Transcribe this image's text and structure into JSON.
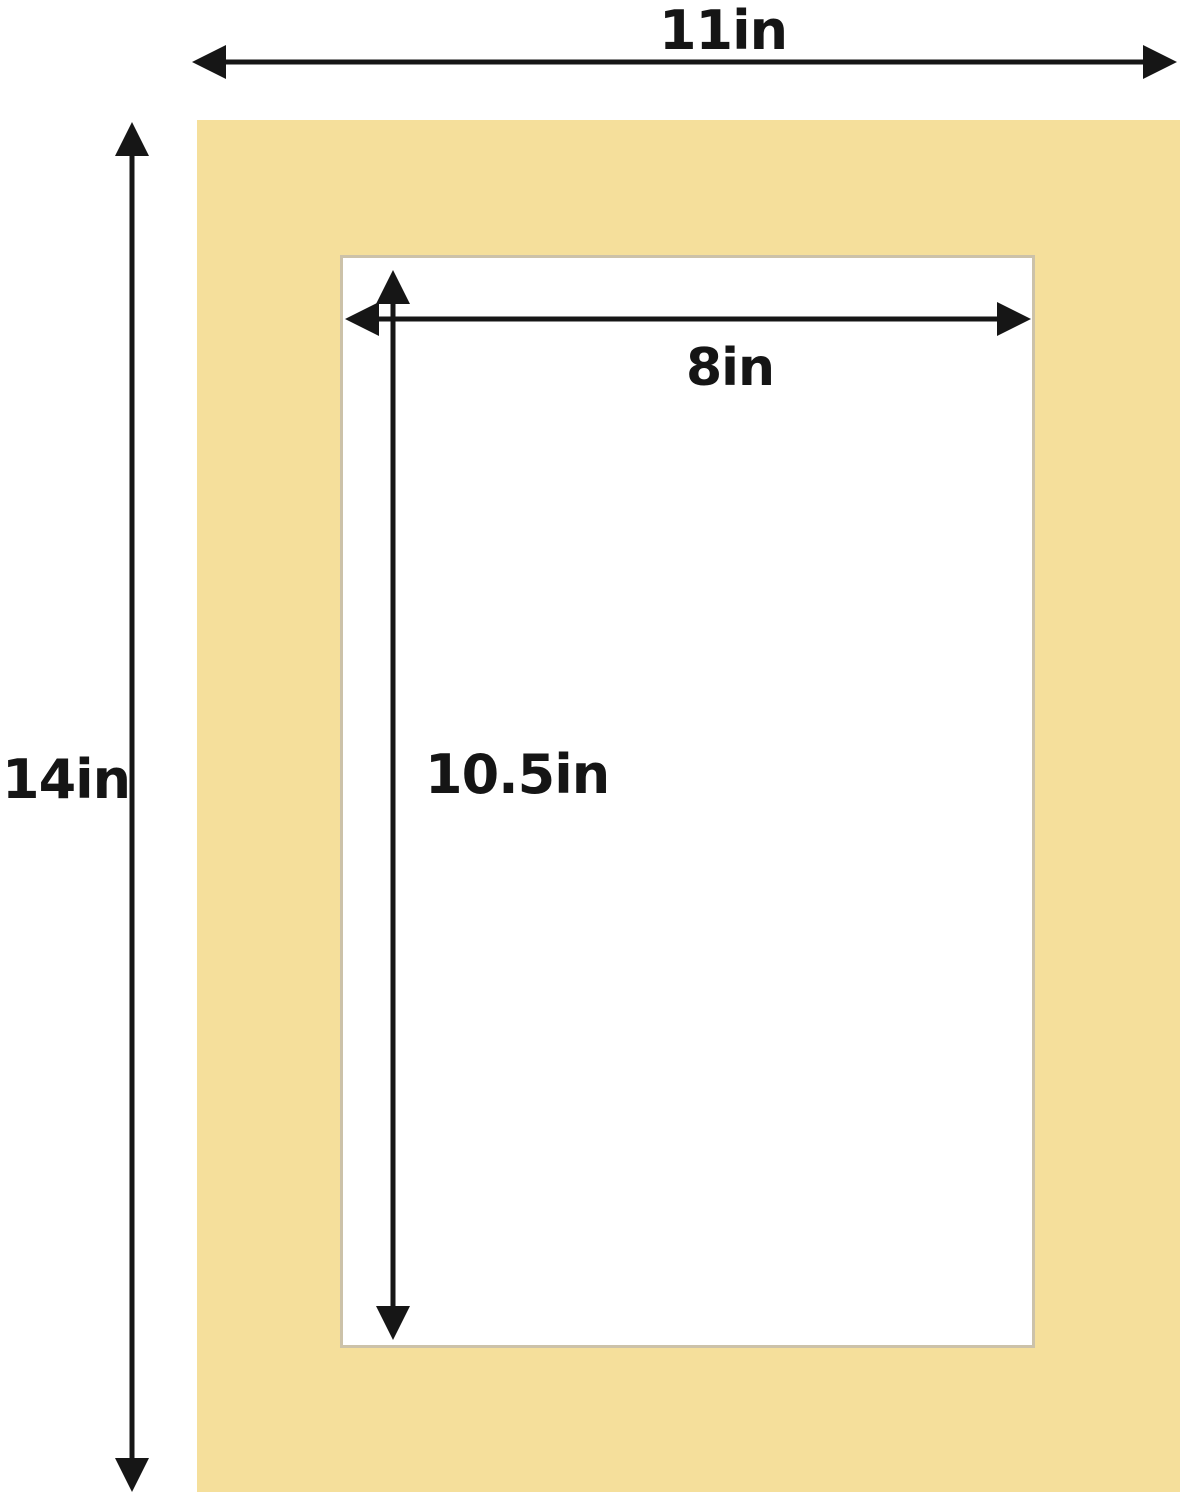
{
  "diagram": {
    "type": "product-dimension-diagram",
    "subject": "picture frame mat board with rectangular opening",
    "labels": {
      "outer_width": "11in",
      "outer_height": "14in",
      "opening_width": "8in",
      "opening_height": "10.5in"
    },
    "dimensions": {
      "outer": {
        "width_in": 11,
        "height_in": 14
      },
      "opening": {
        "width_in": 8,
        "height_in": 10.5
      }
    },
    "colors": {
      "mat": "#f5df9b",
      "bevel": "#ccc2a9",
      "arrow": "#161616",
      "background": "#ffffff",
      "text": "#151515"
    },
    "icons": [
      "double-headed-arrow-horizontal-icon",
      "double-headed-arrow-vertical-icon"
    ]
  }
}
